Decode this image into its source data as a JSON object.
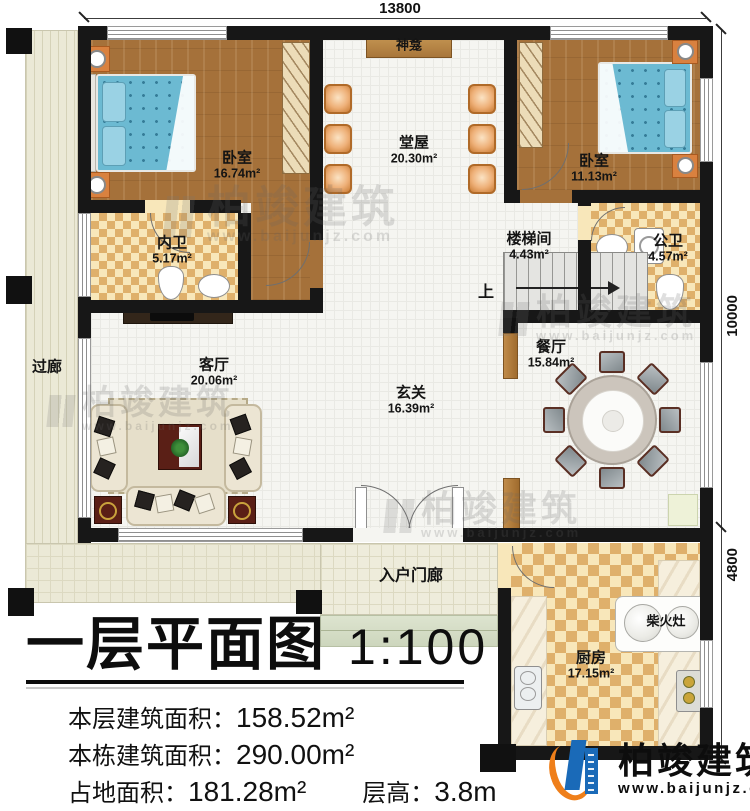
{
  "dimensions": {
    "width_top": "13800",
    "depth_upper": "10000",
    "depth_lower": "4800"
  },
  "rooms": {
    "bedroom_left": {
      "name": "卧室",
      "area": "16.74m²"
    },
    "ensuite_bath": {
      "name": "内卫",
      "area": "5.17m²"
    },
    "central_hall": {
      "name": "堂屋",
      "area": "20.30m²"
    },
    "shrine": {
      "name": "神龛",
      "area": ""
    },
    "bedroom_right": {
      "name": "卧室",
      "area": "11.13m²"
    },
    "stair_room": {
      "name": "楼梯间",
      "area": "4.43m²"
    },
    "public_bath": {
      "name": "公卫",
      "area": "4.57m²"
    },
    "dining_room": {
      "name": "餐厅",
      "area": "15.84m²"
    },
    "corridor": {
      "name": "过廊",
      "area": ""
    },
    "living_room": {
      "name": "客厅",
      "area": "20.06m²"
    },
    "foyer": {
      "name": "玄关",
      "area": "16.39m²"
    },
    "entry_porch": {
      "name": "入户门廊",
      "area": ""
    },
    "kitchen": {
      "name": "厨房",
      "area": "17.15m²"
    },
    "wood_stove": {
      "name": "柴火灶",
      "area": ""
    }
  },
  "stairs": {
    "up_label": "上"
  },
  "title_block": {
    "title": "一层平面图",
    "scale": "1:100",
    "rows": [
      {
        "label": "本层建筑面积：",
        "value": "158.52m²"
      },
      {
        "label": "本栋建筑面积：",
        "value": "290.00m²"
      },
      {
        "label": "占地面积：",
        "value": "181.28m²",
        "label2": "层高：",
        "value2": "3.8m"
      }
    ]
  },
  "branding": {
    "name": "柏竣建筑",
    "website": "www.baijunjz.com"
  },
  "watermark": {
    "name": "柏竣建筑",
    "website": "www.baijunjz.com"
  },
  "colors": {
    "wall": "#171717",
    "wood_floor": "#a5713a",
    "tile_light": "#f8e7ba",
    "tile_dark": "#dfb06b",
    "terrace": "#ebe9d6",
    "bed": "#6cbad2",
    "chair": "#eeb078",
    "logo_blue": "#1a6ab8",
    "logo_orange": "#ef7f1a"
  }
}
